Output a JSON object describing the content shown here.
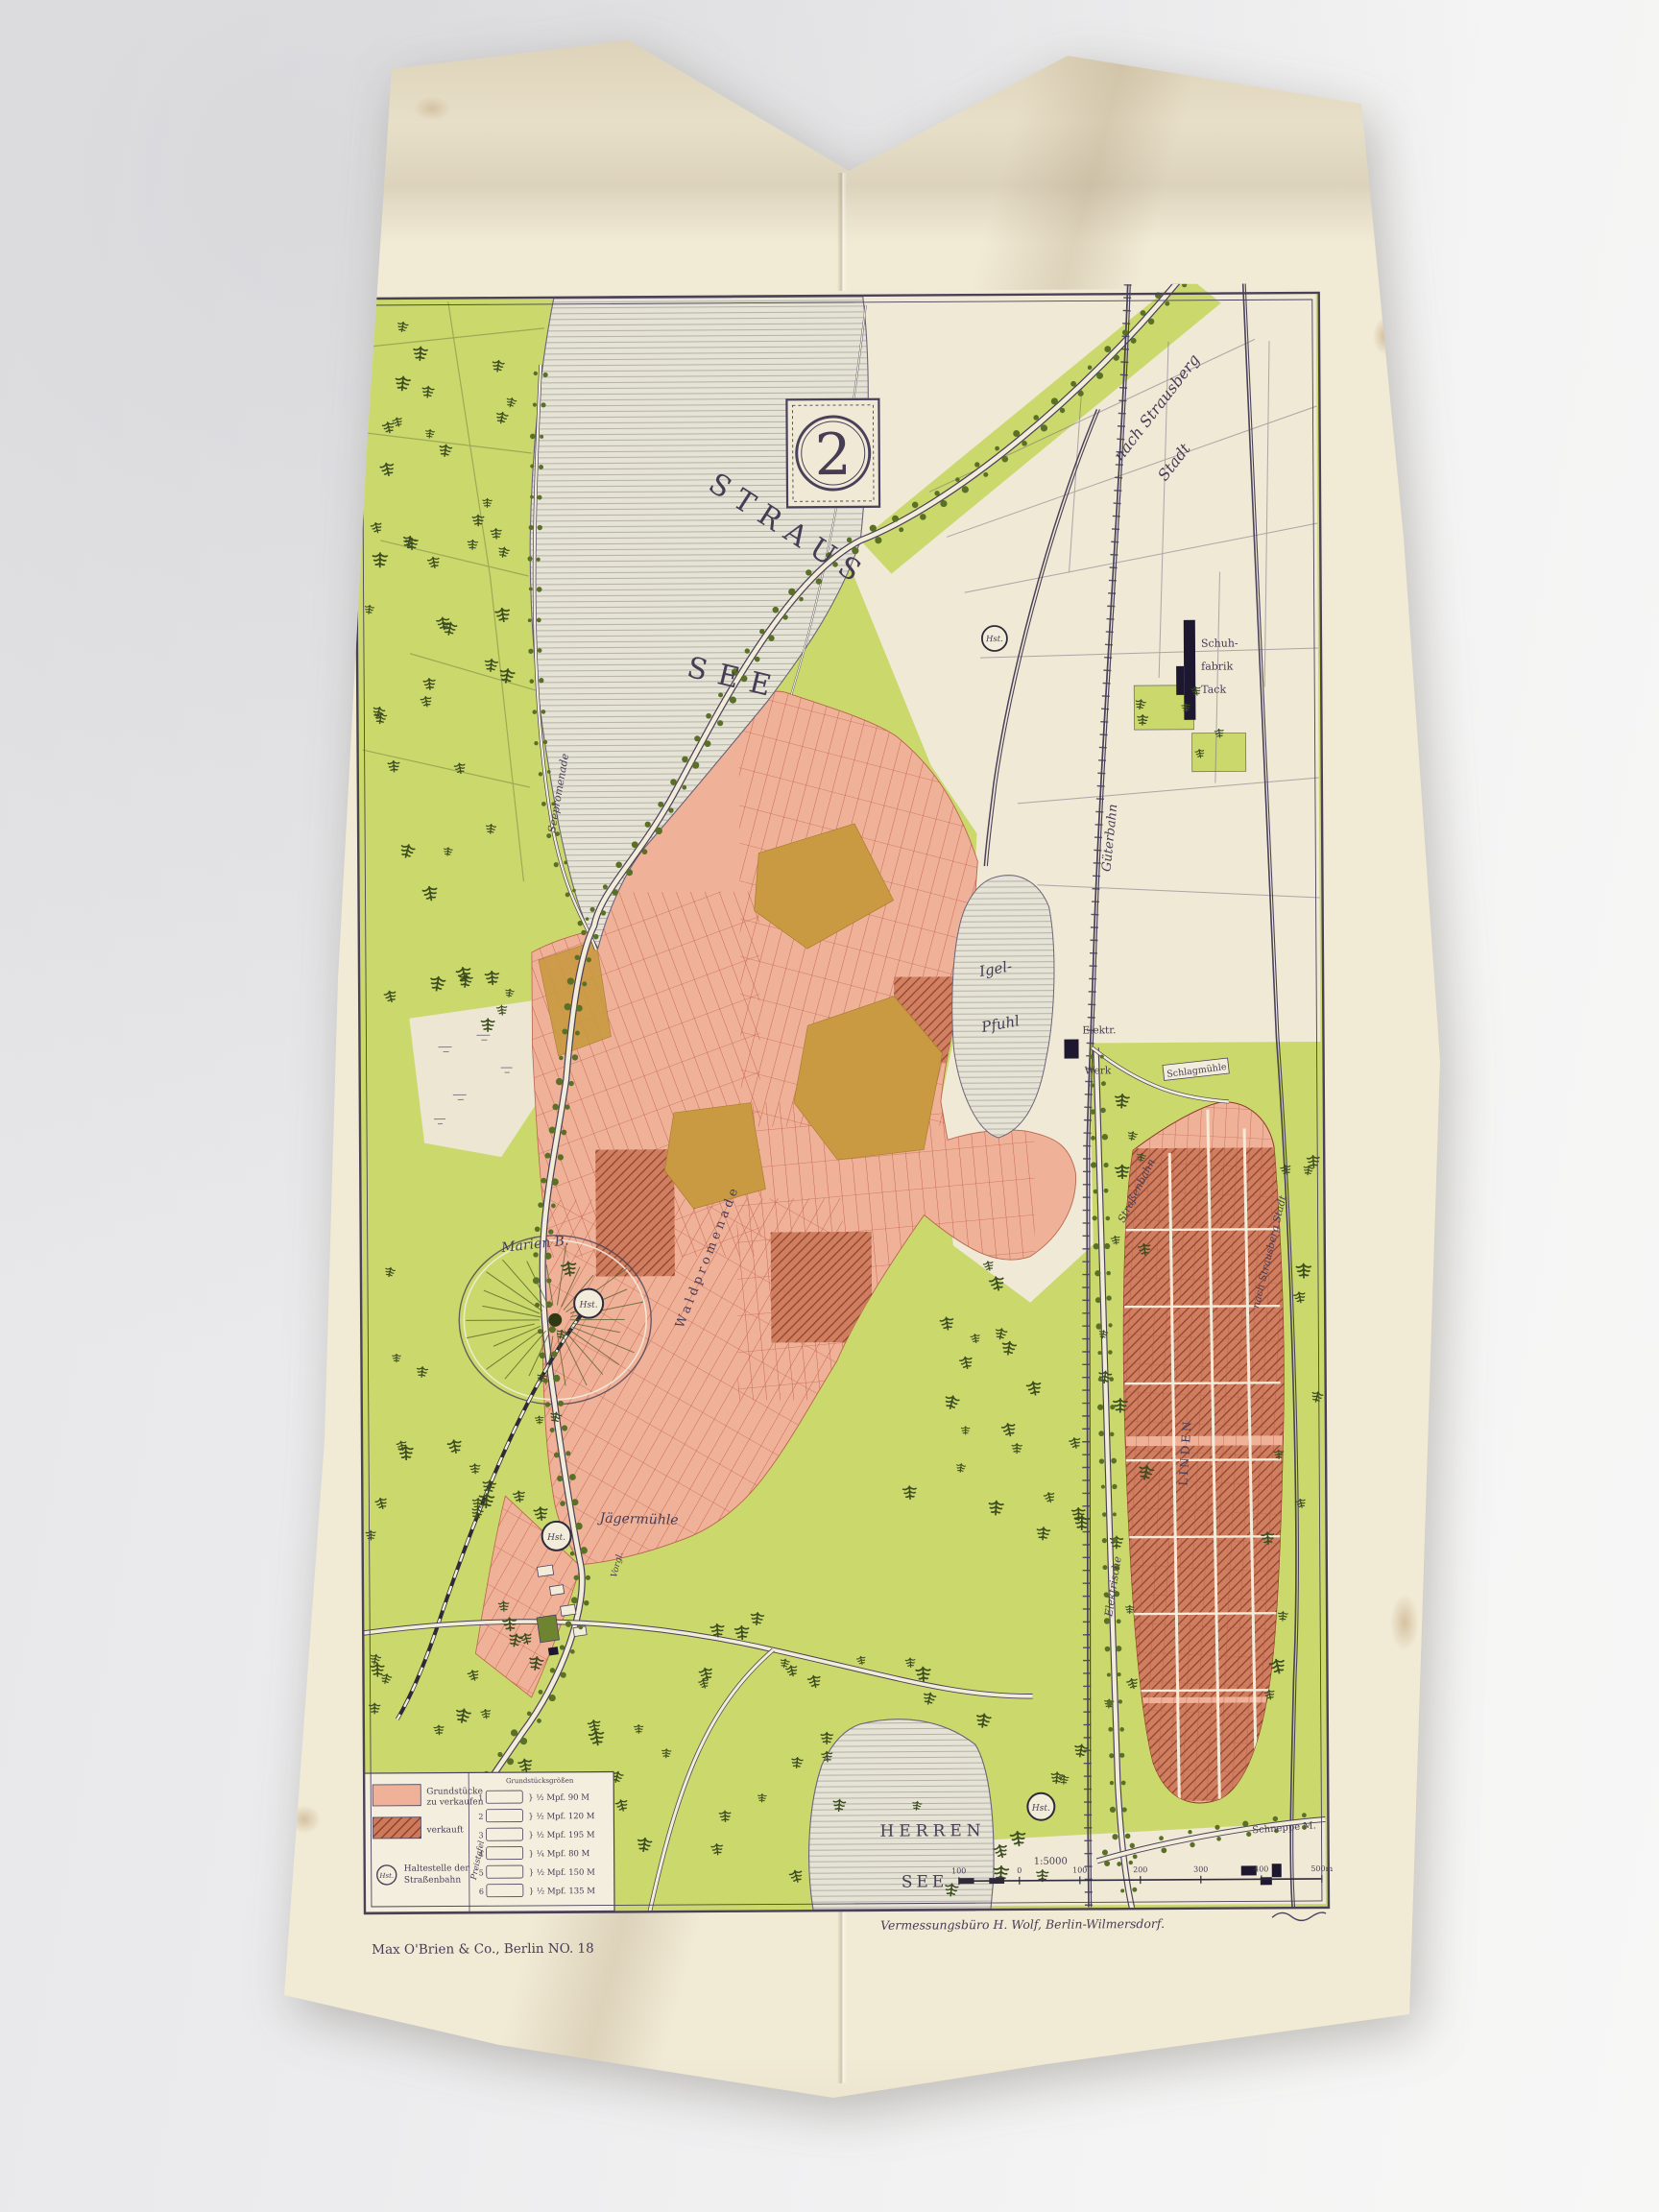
{
  "photo": {
    "backdrop": "#ebebed",
    "paper": "#f1ead5"
  },
  "map": {
    "plate_number": "2",
    "title_lake": {
      "line1": "STRAUS",
      "line2": "SEE"
    },
    "labels": {
      "nach_strausberg": "nach Strausberg",
      "stadt": "Stadt",
      "gueterbahn": "Güterbahn",
      "schuhfabrik_1": "Schuh-",
      "schuhfabrik_2": "fabrik",
      "schuhfabrik_3": "Tack",
      "igel_1": "Igel-",
      "igel_2": "Pfuhl",
      "elektr_1": "Elektr.",
      "elektr_2": "Werk",
      "herren_1": "HERREN",
      "herren_2": "SEE",
      "marienberg": "Marien B.",
      "hst": "Hst.",
      "jaegermuehle": "Jägermühle",
      "seepromenade": "Seepromenade",
      "waldpromenade": "Waldpromenade",
      "vorgl": "Vorgl.",
      "strassenbahn": "Straßenbahn",
      "elektrische": "Elektrische",
      "nach_strausberg_stadt": "nach Strausberg Stadt",
      "linden": "LINDEN",
      "schlagmuehle": "Schlagmühle",
      "schneppe": "Schneppe M."
    },
    "scale": {
      "ratio": "1:5000",
      "ticks": [
        "100",
        "0",
        "100",
        "200",
        "300",
        "400",
        "500m"
      ]
    },
    "legend": {
      "for_sale_1": "Grundstücke",
      "for_sale_2": "zu verkaufen",
      "sold": "verkauft",
      "stop_1": "Haltestelle der",
      "stop_2": "Straßenbahn",
      "stop_abbrev": "Hst.",
      "price_title": "Preistafel",
      "price_header": "Grundstücksgrößen",
      "rows": [
        {
          "num": "1",
          "price": "½ Mpf. 90 M"
        },
        {
          "num": "2",
          "price": "½ Mpf. 120 M"
        },
        {
          "num": "3",
          "price": "½ Mpf. 195 M"
        },
        {
          "num": "4",
          "price": "¼ Mpf. 80 M"
        },
        {
          "num": "5",
          "price": "½ Mpf. 150 M"
        },
        {
          "num": "6",
          "price": "½ Mpf. 135 M"
        }
      ]
    },
    "imprints": {
      "publisher": "Max O'Brien & Co., Berlin NO. 18",
      "surveyor": "Vermessungsbüro H. Wolf, Berlin-Wilmersdorf."
    },
    "colors": {
      "green": "#cbd86c",
      "pink": "#f0b199",
      "sold": "#b0553c",
      "ochre": "#c99a41",
      "lake": "#e4e1d5",
      "ink": "#49415a"
    }
  }
}
